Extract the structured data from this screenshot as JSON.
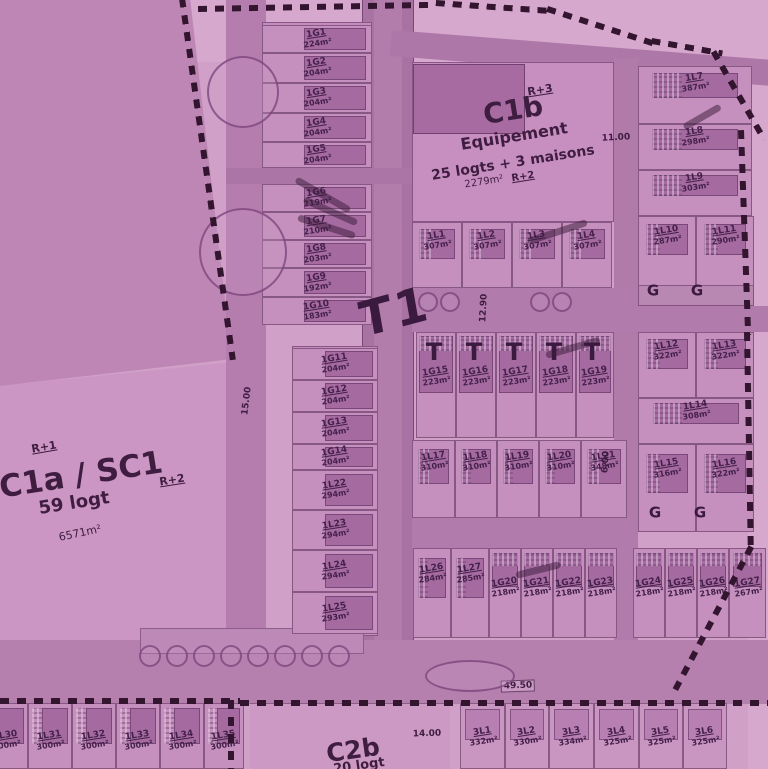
{
  "palette": {
    "background": "#d0a0c8",
    "parcel": "#bd86b5",
    "lot_fill": "#c590bd",
    "building": "#a56ba0",
    "road": "#a873a3",
    "boundary_dash": "#33152f",
    "ink": "#44204a"
  },
  "zones": {
    "t1": {
      "name": "T1"
    },
    "c1a": {
      "name": "C1a / SC1",
      "logt": "59 logt",
      "area": "6571m²",
      "floors_left": "R+1",
      "floors_right": "R+2"
    },
    "c1b": {
      "name": "C1b",
      "floors": "R+3",
      "line1": "Equipement",
      "line2": "25 logts + 3 maisons",
      "area": "2279m²",
      "floors2": "R+2"
    },
    "c2b": {
      "name": "C2b",
      "logt": "20 logt"
    }
  },
  "dims": [
    {
      "text": "15.00",
      "x": 247,
      "y": 401,
      "rot": -83
    },
    {
      "text": "12.90",
      "x": 484,
      "y": 308,
      "rot": -87
    },
    {
      "text": "11.00",
      "x": 616,
      "y": 138,
      "rot": -3
    },
    {
      "text": "6.00",
      "x": 606,
      "y": 462,
      "rot": -87
    },
    {
      "text": "49.50",
      "x": 518,
      "y": 686,
      "rot": -2,
      "boxed": true
    },
    {
      "text": "14.00",
      "x": 427,
      "y": 734,
      "rot": -2
    }
  ],
  "lots": [
    {
      "id": "1G1",
      "area": "224m²",
      "x": 262,
      "y": 25,
      "w": 110,
      "h": 28,
      "cls": "strip"
    },
    {
      "id": "1G2",
      "area": "204m²",
      "x": 262,
      "y": 53,
      "w": 110,
      "h": 30,
      "cls": "strip"
    },
    {
      "id": "1G3",
      "area": "204m²",
      "x": 262,
      "y": 83,
      "w": 110,
      "h": 30,
      "cls": "strip"
    },
    {
      "id": "1G4",
      "area": "204m²",
      "x": 262,
      "y": 113,
      "w": 110,
      "h": 29,
      "cls": "strip"
    },
    {
      "id": "1G5",
      "area": "204m²",
      "x": 262,
      "y": 142,
      "w": 110,
      "h": 26,
      "cls": "strip"
    },
    {
      "id": "1G6",
      "area": "219m²",
      "x": 262,
      "y": 184,
      "w": 110,
      "h": 28,
      "cls": "strip"
    },
    {
      "id": "1G7",
      "area": "210m²",
      "x": 262,
      "y": 212,
      "w": 110,
      "h": 28,
      "cls": "strip"
    },
    {
      "id": "1G8",
      "area": "203m²",
      "x": 262,
      "y": 240,
      "w": 110,
      "h": 28,
      "cls": "strip"
    },
    {
      "id": "1G9",
      "area": "192m²",
      "x": 262,
      "y": 268,
      "w": 110,
      "h": 29,
      "cls": "strip"
    },
    {
      "id": "1G10",
      "area": "183m²",
      "x": 262,
      "y": 297,
      "w": 110,
      "h": 28,
      "cls": "strip"
    },
    {
      "id": "1G11",
      "area": "204m²",
      "x": 292,
      "y": 348,
      "w": 86,
      "h": 32,
      "cls": "strip"
    },
    {
      "id": "1G12",
      "area": "204m²",
      "x": 292,
      "y": 380,
      "w": 86,
      "h": 32,
      "cls": "strip"
    },
    {
      "id": "1G13",
      "area": "204m²",
      "x": 292,
      "y": 412,
      "w": 86,
      "h": 32,
      "cls": "strip"
    },
    {
      "id": "1G14",
      "area": "204m²",
      "x": 292,
      "y": 444,
      "w": 86,
      "h": 26,
      "cls": "strip"
    },
    {
      "id": "1L22",
      "area": "294m²",
      "x": 292,
      "y": 470,
      "w": 86,
      "h": 40,
      "cls": "strip"
    },
    {
      "id": "1L23",
      "area": "294m²",
      "x": 292,
      "y": 510,
      "w": 86,
      "h": 40,
      "cls": "strip"
    },
    {
      "id": "1L24",
      "area": "294m²",
      "x": 292,
      "y": 550,
      "w": 86,
      "h": 42,
      "cls": "strip"
    },
    {
      "id": "1L25",
      "area": "293m²",
      "x": 292,
      "y": 592,
      "w": 86,
      "h": 42,
      "cls": "strip"
    },
    {
      "id": "1L1",
      "area": "307m²",
      "x": 412,
      "y": 222,
      "w": 50,
      "h": 66,
      "cls": "house"
    },
    {
      "id": "1L2",
      "area": "307m²",
      "x": 462,
      "y": 222,
      "w": 50,
      "h": 66,
      "cls": "house"
    },
    {
      "id": "1L3",
      "area": "307m²",
      "x": 512,
      "y": 222,
      "w": 50,
      "h": 66,
      "cls": "house"
    },
    {
      "id": "1L4",
      "area": "307m²",
      "x": 562,
      "y": 222,
      "w": 50,
      "h": 66,
      "cls": "house"
    },
    {
      "id": "1L7",
      "area": "387m²",
      "x": 638,
      "y": 66,
      "w": 114,
      "h": 58,
      "cls": "house"
    },
    {
      "id": "1L8",
      "area": "298m²",
      "x": 638,
      "y": 124,
      "w": 114,
      "h": 46,
      "cls": "house"
    },
    {
      "id": "1L9",
      "area": "303m²",
      "x": 638,
      "y": 170,
      "w": 114,
      "h": 46,
      "cls": "house"
    },
    {
      "id": "1L10",
      "area": "287m²",
      "x": 638,
      "y": 216,
      "w": 58,
      "h": 70,
      "cls": "house"
    },
    {
      "id": "1L11",
      "area": "290m²",
      "x": 696,
      "y": 216,
      "w": 58,
      "h": 70,
      "cls": "house"
    },
    {
      "id": "1G15",
      "area": "223m²",
      "x": 416,
      "y": 332,
      "w": 40,
      "h": 106,
      "cls": "trow"
    },
    {
      "id": "1G16",
      "area": "223m²",
      "x": 456,
      "y": 332,
      "w": 40,
      "h": 106,
      "cls": "trow"
    },
    {
      "id": "1G17",
      "area": "223m²",
      "x": 496,
      "y": 332,
      "w": 40,
      "h": 106,
      "cls": "trow"
    },
    {
      "id": "1G18",
      "area": "223m²",
      "x": 536,
      "y": 332,
      "w": 40,
      "h": 106,
      "cls": "trow"
    },
    {
      "id": "1G19",
      "area": "223m²",
      "x": 576,
      "y": 332,
      "w": 38,
      "h": 106,
      "cls": "trow"
    },
    {
      "id": "1L17",
      "area": "310m²",
      "x": 412,
      "y": 440,
      "w": 43,
      "h": 78,
      "cls": "house"
    },
    {
      "id": "1L18",
      "area": "310m²",
      "x": 455,
      "y": 440,
      "w": 42,
      "h": 78,
      "cls": "house"
    },
    {
      "id": "1L19",
      "area": "310m²",
      "x": 497,
      "y": 440,
      "w": 42,
      "h": 78,
      "cls": "house"
    },
    {
      "id": "1L20",
      "area": "310m²",
      "x": 539,
      "y": 440,
      "w": 42,
      "h": 78,
      "cls": "house"
    },
    {
      "id": "1L21",
      "area": "348m²",
      "x": 581,
      "y": 440,
      "w": 46,
      "h": 78,
      "cls": "house"
    },
    {
      "id": "1L12",
      "area": "322m²",
      "x": 638,
      "y": 332,
      "w": 58,
      "h": 66,
      "cls": "house"
    },
    {
      "id": "1L13",
      "area": "322m²",
      "x": 696,
      "y": 332,
      "w": 58,
      "h": 66,
      "cls": "house"
    },
    {
      "id": "1L14",
      "area": "308m²",
      "x": 638,
      "y": 398,
      "w": 116,
      "h": 46,
      "cls": "house"
    },
    {
      "id": "1L15",
      "area": "316m²",
      "x": 638,
      "y": 444,
      "w": 58,
      "h": 88,
      "cls": "house"
    },
    {
      "id": "1L16",
      "area": "322m²",
      "x": 696,
      "y": 444,
      "w": 58,
      "h": 88,
      "cls": "house"
    },
    {
      "id": "1L26",
      "area": "284m²",
      "x": 413,
      "y": 548,
      "w": 38,
      "h": 90,
      "cls": "house"
    },
    {
      "id": "1L27",
      "area": "285m²",
      "x": 451,
      "y": 548,
      "w": 38,
      "h": 90,
      "cls": "house"
    },
    {
      "id": "1G20",
      "area": "218m²",
      "x": 489,
      "y": 548,
      "w": 32,
      "h": 90,
      "cls": "small"
    },
    {
      "id": "1G21",
      "area": "218m²",
      "x": 521,
      "y": 548,
      "w": 32,
      "h": 90,
      "cls": "small"
    },
    {
      "id": "1G22",
      "area": "218m²",
      "x": 553,
      "y": 548,
      "w": 32,
      "h": 90,
      "cls": "small"
    },
    {
      "id": "1G23",
      "area": "218m²",
      "x": 585,
      "y": 548,
      "w": 32,
      "h": 90,
      "cls": "small"
    },
    {
      "id": "1G24",
      "area": "218m²",
      "x": 633,
      "y": 548,
      "w": 32,
      "h": 90,
      "cls": "small"
    },
    {
      "id": "1G25",
      "area": "218m²",
      "x": 665,
      "y": 548,
      "w": 32,
      "h": 90,
      "cls": "small"
    },
    {
      "id": "1G26",
      "area": "218m²",
      "x": 697,
      "y": 548,
      "w": 32,
      "h": 90,
      "cls": "small"
    },
    {
      "id": "1G27",
      "area": "267m²",
      "x": 729,
      "y": 548,
      "w": 37,
      "h": 90,
      "cls": "small"
    },
    {
      "id": "1L30",
      "area": "300m²",
      "x": -16,
      "y": 703,
      "w": 44,
      "h": 66,
      "cls": "blot"
    },
    {
      "id": "1L31",
      "area": "300m²",
      "x": 28,
      "y": 703,
      "w": 44,
      "h": 66,
      "cls": "blot"
    },
    {
      "id": "1L32",
      "area": "300m²",
      "x": 72,
      "y": 703,
      "w": 44,
      "h": 66,
      "cls": "blot"
    },
    {
      "id": "1L33",
      "area": "300m²",
      "x": 116,
      "y": 703,
      "w": 44,
      "h": 66,
      "cls": "blot"
    },
    {
      "id": "1L34",
      "area": "300m²",
      "x": 160,
      "y": 703,
      "w": 44,
      "h": 66,
      "cls": "blot"
    },
    {
      "id": "1L35",
      "area": "300m²",
      "x": 204,
      "y": 703,
      "w": 40,
      "h": 66,
      "cls": "blot"
    },
    {
      "id": "3L1",
      "area": "332m²",
      "x": 460,
      "y": 703,
      "w": 45,
      "h": 66,
      "cls": "brow"
    },
    {
      "id": "3L2",
      "area": "330m²",
      "x": 505,
      "y": 703,
      "w": 44,
      "h": 66,
      "cls": "brow"
    },
    {
      "id": "3L3",
      "area": "334m²",
      "x": 549,
      "y": 703,
      "w": 45,
      "h": 66,
      "cls": "brow"
    },
    {
      "id": "3L4",
      "area": "325m²",
      "x": 594,
      "y": 703,
      "w": 45,
      "h": 66,
      "cls": "brow"
    },
    {
      "id": "3L5",
      "area": "325m²",
      "x": 639,
      "y": 703,
      "w": 44,
      "h": 66,
      "cls": "brow"
    },
    {
      "id": "3L6",
      "area": "325m²",
      "x": 683,
      "y": 703,
      "w": 44,
      "h": 66,
      "cls": "brow"
    }
  ],
  "t_marks": [
    {
      "glyph": "T",
      "x": 434,
      "y": 352
    },
    {
      "glyph": "T",
      "x": 474,
      "y": 352
    },
    {
      "glyph": "T",
      "x": 514,
      "y": 352
    },
    {
      "glyph": "T",
      "x": 554,
      "y": 352
    },
    {
      "glyph": "T",
      "x": 592,
      "y": 352
    }
  ],
  "garage_labels": [
    {
      "glyph": "G",
      "x": 653,
      "y": 291
    },
    {
      "glyph": "G",
      "x": 697,
      "y": 291
    },
    {
      "glyph": "G",
      "x": 655,
      "y": 513
    },
    {
      "glyph": "G",
      "x": 700,
      "y": 513
    }
  ],
  "trees": [
    {
      "cx": 243,
      "cy": 92,
      "r": 36
    },
    {
      "cx": 243,
      "cy": 252,
      "r": 44
    },
    {
      "cx": 428,
      "cy": 302,
      "r": 10
    },
    {
      "cx": 450,
      "cy": 302,
      "r": 10
    },
    {
      "cx": 540,
      "cy": 302,
      "r": 10
    },
    {
      "cx": 562,
      "cy": 302,
      "r": 10
    },
    {
      "cx": 150,
      "cy": 656,
      "r": 11
    },
    {
      "cx": 177,
      "cy": 656,
      "r": 11
    },
    {
      "cx": 204,
      "cy": 656,
      "r": 11
    },
    {
      "cx": 231,
      "cy": 656,
      "r": 11
    },
    {
      "cx": 258,
      "cy": 656,
      "r": 11
    },
    {
      "cx": 285,
      "cy": 656,
      "r": 11
    },
    {
      "cx": 312,
      "cy": 656,
      "r": 11
    },
    {
      "cx": 339,
      "cy": 656,
      "r": 11
    },
    {
      "cx": 470,
      "cy": 676,
      "r": 45,
      "ry": 16
    }
  ],
  "dashes": [
    {
      "x": 185,
      "y": -2,
      "len": 365,
      "rot": 82
    },
    {
      "x": 198,
      "y": 6,
      "len": 235,
      "rot": -1
    },
    {
      "x": 436,
      "y": 0,
      "len": 115,
      "rot": 4
    },
    {
      "x": 548,
      "y": 6,
      "len": 112,
      "rot": 18
    },
    {
      "x": 652,
      "y": 38,
      "len": 72,
      "rot": 10
    },
    {
      "x": 716,
      "y": 50,
      "len": 102,
      "rot": 60
    },
    {
      "x": 744,
      "y": 130,
      "len": 205,
      "rot": 88
    },
    {
      "x": 750,
      "y": 332,
      "len": 218,
      "rot": 89
    },
    {
      "x": 754,
      "y": 548,
      "len": 162,
      "rot": 118
    },
    {
      "x": 0,
      "y": 698,
      "len": 240,
      "rot": 0
    },
    {
      "x": 240,
      "y": 700,
      "len": 528,
      "rot": 0
    },
    {
      "x": 234,
      "y": 700,
      "len": 70,
      "rot": 90
    }
  ],
  "scribbles": [
    {
      "x": 296,
      "y": 176,
      "len": 62,
      "rot": 30
    },
    {
      "x": 304,
      "y": 196,
      "len": 58,
      "rot": 24
    },
    {
      "x": 298,
      "y": 214,
      "len": 60,
      "rot": 18
    },
    {
      "x": 528,
      "y": 238,
      "len": 62,
      "rot": -18
    },
    {
      "x": 546,
      "y": 352,
      "len": 56,
      "rot": -16
    },
    {
      "x": 516,
      "y": 572,
      "len": 46,
      "rot": -14
    },
    {
      "x": 684,
      "y": 124,
      "len": 42,
      "rot": -30
    }
  ]
}
